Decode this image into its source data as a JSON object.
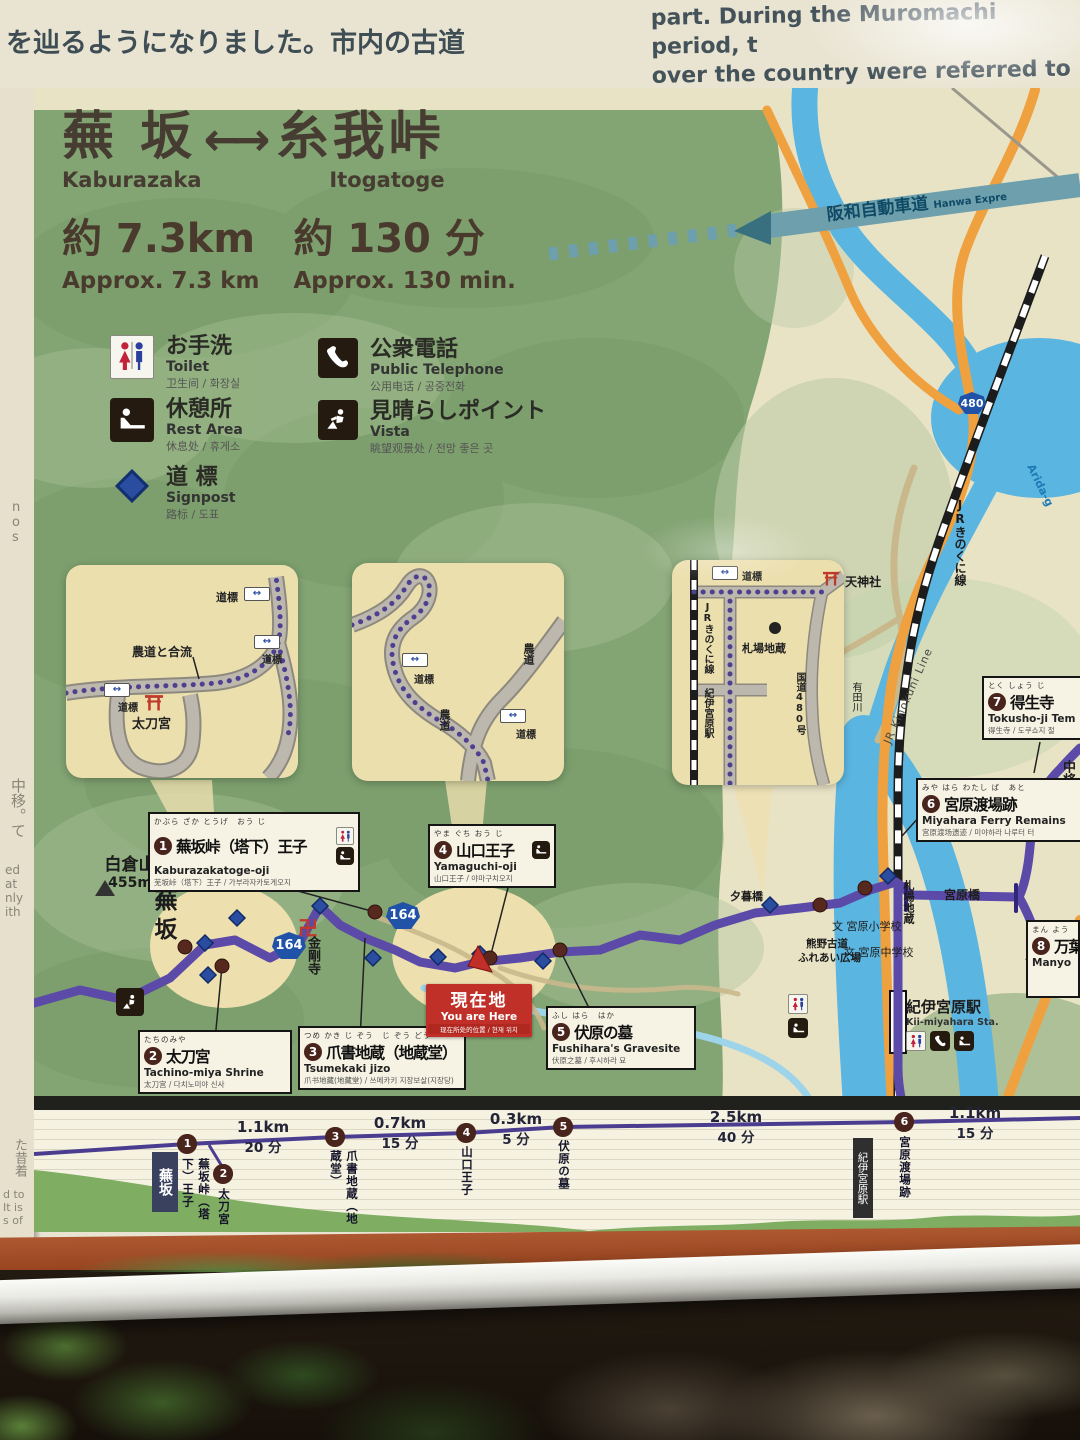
{
  "intro": {
    "jp_line1": "を辿るようになりました。市内の古道",
    "jp_line2": "ができます。",
    "en_lines": "part. During the Muromachi period, t\nover the country were referred to as\nin Arida City, visitors can still see mar"
  },
  "title": {
    "from_jp": "蕪 坂",
    "from_en": "Kaburazaka",
    "arrow": "←→",
    "to_jp": "糸我峠",
    "to_en": "Itogatoge",
    "distance_jp": "約 7.3km",
    "distance_en": "Approx. 7.3 km",
    "time_jp": "約 130 分",
    "time_en": "Approx. 130 min."
  },
  "legend": {
    "items": [
      {
        "jp": "お手洗",
        "en": "Toilet",
        "cjk": "卫生间 / 화장실",
        "icon": "toilet"
      },
      {
        "jp": "休憩所",
        "en": "Rest Area",
        "cjk": "休息处 / 휴게소",
        "icon": "rest-area"
      },
      {
        "jp": "道 標",
        "en": "Signpost",
        "cjk": "路标 / 도표",
        "icon": "signpost"
      },
      {
        "jp": "公衆電話",
        "en": "Public Telephone",
        "cjk": "公用电话 / 공중전화",
        "icon": "public-telephone"
      },
      {
        "jp": "見晴らしポイント",
        "en": "Vista",
        "cjk": "眺望观景处 / 전망 좋은 곳",
        "icon": "vista"
      }
    ]
  },
  "common": {
    "douhyou": "道標"
  },
  "insets": {
    "first": {
      "merge": "農道と合流",
      "shrine": "太刀宮"
    },
    "second": {
      "farm_road": "農道"
    },
    "third": {
      "jr": "JRきのくに線",
      "station": "紀伊宮原駅",
      "jizo": "札場地蔵",
      "route": "国道480号"
    }
  },
  "map": {
    "expressway_jp": "阪和自動車道",
    "expressway_en": "Hanwa Expre",
    "mountain": "白倉山",
    "elevation": "455m",
    "kaburazaka": "蕪坂",
    "manji": "卍",
    "kongoji": "金剛寺",
    "route164": "164",
    "route480": "480",
    "jr_line_en": "JR Kinokuni Line",
    "jr_line_jp": "JRきのくに線",
    "river_en": "Arida-g",
    "river_jp": "有田川",
    "tenjin": "天神社",
    "fudaba_jizo": "札場地蔵",
    "miyahara_bridge": "宮原橋",
    "yugure_bridge": "夕暮橋",
    "kumano1": "熊野古道",
    "kumano2": "ふれあい広場",
    "school_mark": "文",
    "elementary": "宮原小学校",
    "junior_high": "宮原中学校",
    "station_jp": "紀伊宮原駅",
    "station_en": "Kii-miyahara Sta.",
    "chujo": "中将姫の看"
  },
  "you_are_here": {
    "jp": "現在地",
    "en": "You are Here",
    "cjk": "现在所处的位置 / 현재 위치"
  },
  "spots": [
    {
      "num": "1",
      "furigana": "かぶら ざか とうげ　おう じ",
      "jp": "蕪坂峠（塔下）王子",
      "en": "Kaburazakatoge-oji",
      "cjk": "芜坂峠（塔下）王子 / 가부라자카토게오지"
    },
    {
      "num": "2",
      "furigana": "たちのみや",
      "jp": "太刀宮",
      "en": "Tachino-miya Shrine",
      "cjk": "太刀宫 / 다치노미야 신사"
    },
    {
      "num": "3",
      "furigana": "つめ かき じ ぞう　じ ぞう どう",
      "jp": "爪書地蔵（地蔵堂）",
      "en": "Tsumekaki jizo",
      "cjk": "爪书地藏(地藏堂) / 쓰메카키 지장보살(지장당)"
    },
    {
      "num": "4",
      "furigana": "やま ぐち おう じ",
      "jp": "山口王子",
      "en": "Yamaguchi-oji",
      "cjk": "山口王子 / 야마구치오지"
    },
    {
      "num": "5",
      "furigana": "ふし はら　はか",
      "jp": "伏原の墓",
      "en": "Fushihara's Gravesite",
      "cjk": "伏原之墓 / 후시하라 묘"
    },
    {
      "num": "6",
      "furigana": "みや はら わたし ば　あと",
      "jp": "宮原渡場跡",
      "en": "Miyahara Ferry Remains",
      "cjk": "宫原渡场遗迹 / 미야하라 나루터 터"
    },
    {
      "num": "7",
      "furigana": "とく しょう じ",
      "jp": "得生寺",
      "en": "Tokusho-ji Tem",
      "cjk": "得生寺 / 도쿠쇼지 절"
    },
    {
      "num": "8",
      "furigana": "まん よう",
      "jp": "万葉",
      "en": "Manyo",
      "cjk": ""
    }
  ],
  "profile": {
    "start": "蕪坂",
    "terminus": "紀伊宮原駅",
    "stops": [
      {
        "num": "1",
        "label": "蕪坂峠（塔下）王子"
      },
      {
        "num": "2",
        "label": "太刀宮"
      },
      {
        "num": "3",
        "label": "爪書地蔵（地蔵堂）"
      },
      {
        "num": "4",
        "label": "山口王子"
      },
      {
        "num": "5",
        "label": "伏原の墓"
      },
      {
        "num": "6",
        "label": "宮原渡場跡"
      }
    ],
    "segments": [
      {
        "distance": "1.1km",
        "time": "20 分"
      },
      {
        "distance": "0.7km",
        "time": "15 分"
      },
      {
        "distance": "0.3km",
        "time": "5 分"
      },
      {
        "distance": "2.5km",
        "time": "40 分"
      },
      {
        "distance": "1.1km",
        "time": "15 分"
      }
    ]
  },
  "edge_fragments": {
    "f1": "n\no\ns",
    "f2": "中移。て",
    "f3": "ed\nat\nnly\nith",
    "f4": "た昔着",
    "f5": "d to\nIt is\ns of"
  },
  "colors": {
    "route_purple": "#5b4aa8",
    "river_blue": "#5ab5e0",
    "road_orange": "#efa03f",
    "you_are_here_red": "#c03028",
    "map_green": "#83a473",
    "expressway_teal": "#6d9fac"
  }
}
